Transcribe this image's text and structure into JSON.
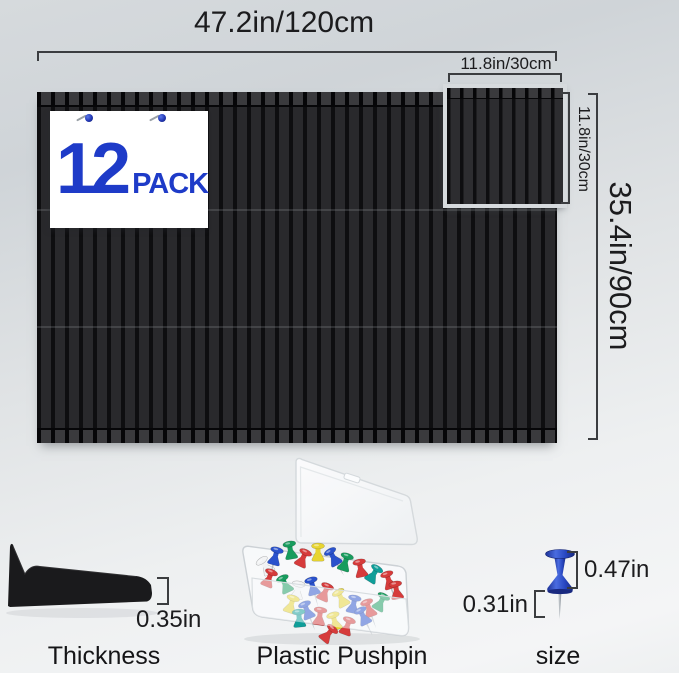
{
  "product": {
    "pack_count": "12",
    "pack_word": "PACK"
  },
  "dimensions": {
    "board_width": "47.2in/120cm",
    "board_height": "35.4in/90cm",
    "tile_width": "11.8in/30cm",
    "tile_height": "11.8in/30cm",
    "thickness": "0.35in",
    "pin_head_height": "0.47in",
    "pin_needle_length": "0.31in"
  },
  "captions": {
    "thickness": "Thickness",
    "pushpin": "Plastic Pushpin",
    "size": "size"
  },
  "colors": {
    "panel_slat": "#29292c",
    "panel_groove": "#0e0e10",
    "panel_halo": "#d6dadd",
    "accent_blue": "#1e3bc8",
    "annotation_text": "#1c1c1e",
    "bracket_line": "#3b3d40",
    "pushpin_palette": [
      "#d63b3b",
      "#2a52cc",
      "#179c5d",
      "#e8d531",
      "#f2f3f4",
      "#0f9e99"
    ]
  }
}
